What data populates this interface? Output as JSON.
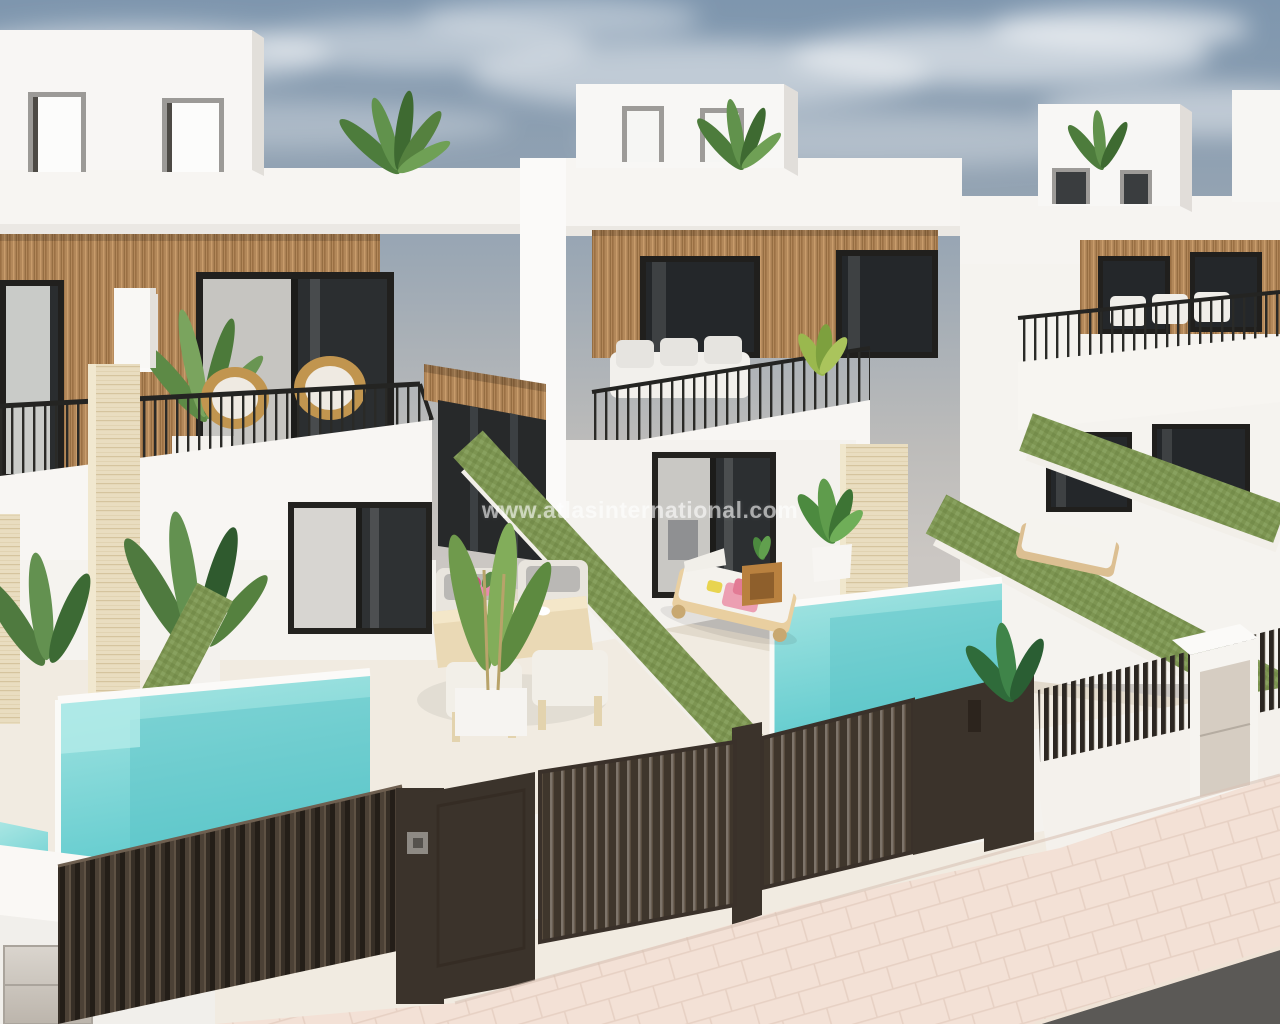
{
  "meta": {
    "type": "3d-architectural-render",
    "subject": "Row of modern white townhouse villas with private plunge pools seen from an elevated street viewpoint"
  },
  "watermark": {
    "text": "www.atlasinternational.com"
  },
  "palette": {
    "sky_top": "#7e96ae",
    "sky_horizon": "#cbc7c3",
    "wall_white": "#f6f4f1",
    "wall_shade": "#e2dfda",
    "wood_cladding": "#b3885a",
    "travertine": "#e9ddc0",
    "green_wall": "#7d9552",
    "pool_water": "#6fd0d2",
    "gate_brown": "#3b332b",
    "terrace_floor": "#f1ebe1",
    "sidewalk": "#f3e1d6",
    "road": "#5b5956",
    "window_glass": "#24272a",
    "railing_black": "#262624"
  },
  "scene": {
    "houses_visible": 3,
    "elements": [
      "rooftop terraces with palm plants",
      "vertical wood slat cladding",
      "black metal balcony railings",
      "rattan armchairs with white cushions",
      "white parapet walls",
      "travertine stone pillars",
      "artificial-grass covered divider walls",
      "turquoise private pools",
      "outdoor dining set with pink flowers",
      "sun lounger with pink towels",
      "dark brown slatted entrance gates",
      "corrugated dark privacy fence",
      "utility meter cabinet",
      "pale pink paved sidewalk",
      "asphalt road"
    ]
  }
}
